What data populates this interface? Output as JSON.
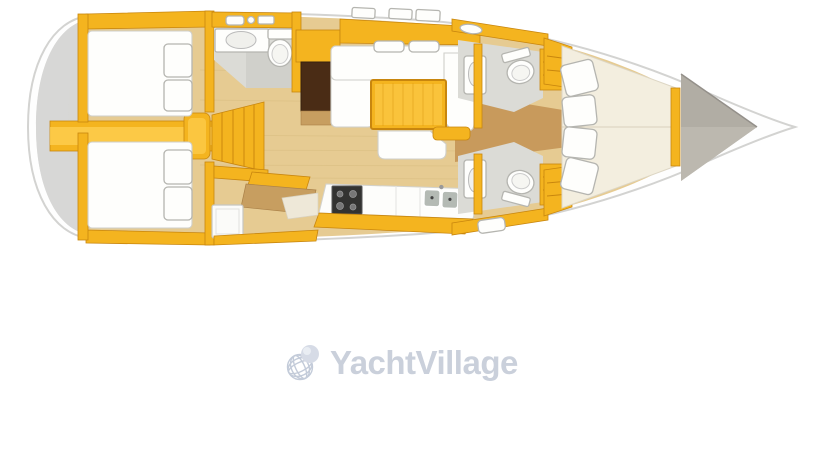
{
  "page": {
    "width": 819,
    "height": 460,
    "background": "#ffffff"
  },
  "watermark": {
    "text": "YachtVillage",
    "icon": "globe-icon"
  },
  "floorplan": {
    "type": "sailing-yacht-deck-plan",
    "orientation": "bow-right",
    "elements": [
      "stern-transom",
      "aft-cabin-port",
      "aft-cabin-starboard",
      "aft-head",
      "companionway-steps",
      "wardrobe",
      "salon-sofa",
      "salon-table",
      "galley-stove",
      "galley-sink",
      "nav-station",
      "forward-head-port",
      "forward-head-starboard",
      "forward-cabin-vberth",
      "anchor-locker"
    ]
  },
  "colors": {
    "page_bg": "#ffffff",
    "hull_fill": "#fefefe",
    "hull_stroke": "#d3d3d1",
    "transom_gray": "#d7d7d5",
    "deck_gray": "#b1ada4",
    "deck_gray_light": "#bcb8af",
    "yellow": "#f4b41f",
    "yellow_dark": "#c8860e",
    "yellow_bright": "#ffd257",
    "floor_light": "#e6cb92",
    "floor_dark": "#c89a5c",
    "grain": "#d9bd80",
    "mattress": "#fefefc",
    "mattress_stroke": "#cfcfca",
    "bed_cream": "#f3eedf",
    "bath_floor": "#dbdbd6",
    "bath_floor_dark": "#d0d0cb",
    "wardrobe_brown": "#4a2c15",
    "wood_desk": "#c79e60",
    "stove_dark": "#333331",
    "sink_gray": "#b4bab4",
    "fixture_stroke": "#b5b5b0",
    "watermark_text": "#cad0db",
    "globe_wire": "#c3cbd9",
    "globe_ball": "#d6dbe6"
  }
}
